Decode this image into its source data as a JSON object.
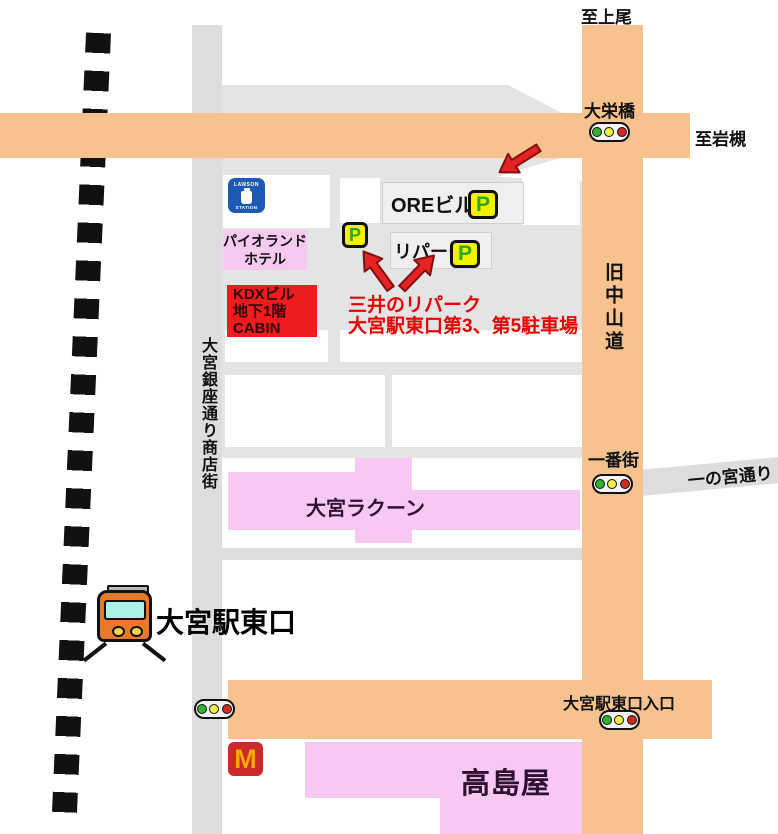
{
  "destinations": {
    "ageo": "至上尾",
    "iwatsuki": "至岩槻"
  },
  "roads": {
    "kyu_nakasendo": "旧中山道",
    "ichinomiya_dori": "一の宮通り",
    "ginza_shopping_street": "大宮銀座通り商店街"
  },
  "intersections": {
    "daieibashi": "大栄橋",
    "ichibangai": "一番街",
    "omiya_east_entrance": "大宮駅東口入口"
  },
  "station": {
    "label": "大宮駅東口"
  },
  "buildings": {
    "ore": "OREビル",
    "ripark": "リパーク",
    "paioland_lines": [
      "パイオランド",
      "ホテル"
    ],
    "kdx_lines": [
      "KDXビル",
      "地下1階",
      "CABIN"
    ],
    "racoon": "大宮ラクーン",
    "takashimaya": "高島屋"
  },
  "parking_note": {
    "line1": "三井のリパーク",
    "line2": "大宮駅東口第3、第5駐車場"
  },
  "icons": {
    "parking_letter": "P",
    "mcdonalds_letter": "M",
    "lawson_top": "LAWSON",
    "lawson_bottom": "STATION"
  },
  "colors": {
    "road_orange": "#F7C28E",
    "road_gray": "#DDDDDD",
    "block_gray": "#E4E4E4",
    "box_gray": "#EFEFEF",
    "pink": "#F9C8F2",
    "hotel_pink": "#F6C9F1",
    "red_box": "#EE1C1C",
    "red_text": "#E80000",
    "parking_yellow": "#F3F000",
    "parking_green": "#28A81E",
    "traffic_green": "#2DB52D",
    "traffic_yellow": "#F2EE42",
    "traffic_red": "#D22A22",
    "train_orange": "#E8792A",
    "window_cyan": "#ADF0E8",
    "mcd_red": "#CC2A2A",
    "mcd_yellow": "#F2A900",
    "lawson_blue": "#1E5AB4",
    "arrow_red": "#E62222",
    "rail_black": "#111111"
  }
}
